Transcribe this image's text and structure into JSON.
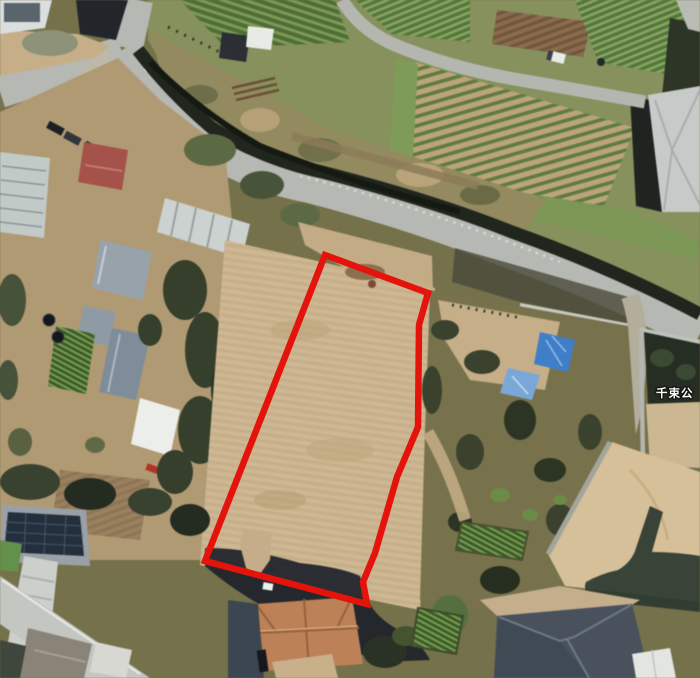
{
  "map": {
    "kind": "satellite-aerial-imagery",
    "place_label": "千束公",
    "place_label_color": "#ffffff"
  },
  "parcel": {
    "outline_points": "325,255 428,293 419,325 418,427 397,477 375,553 363,582 367,604 205,561",
    "outline_color": "#e4130c",
    "outline_width": "6.5",
    "ground_color": "#cbb490"
  },
  "palette": {
    "road": "#b6b8b3",
    "minor_road": "#b4b7b0",
    "hedge_dark": "#20261d",
    "field_green": "#5e7b41",
    "sand_lot": "#d6c09a",
    "tarp_blue_dark": "#3f7ec9",
    "tarp_blue_light": "#79a8d8",
    "shadow": "#1d222a",
    "roof_terracotta": "#bc8157",
    "roof_slate": "#49525c",
    "solar_panel": "#232f3c"
  }
}
